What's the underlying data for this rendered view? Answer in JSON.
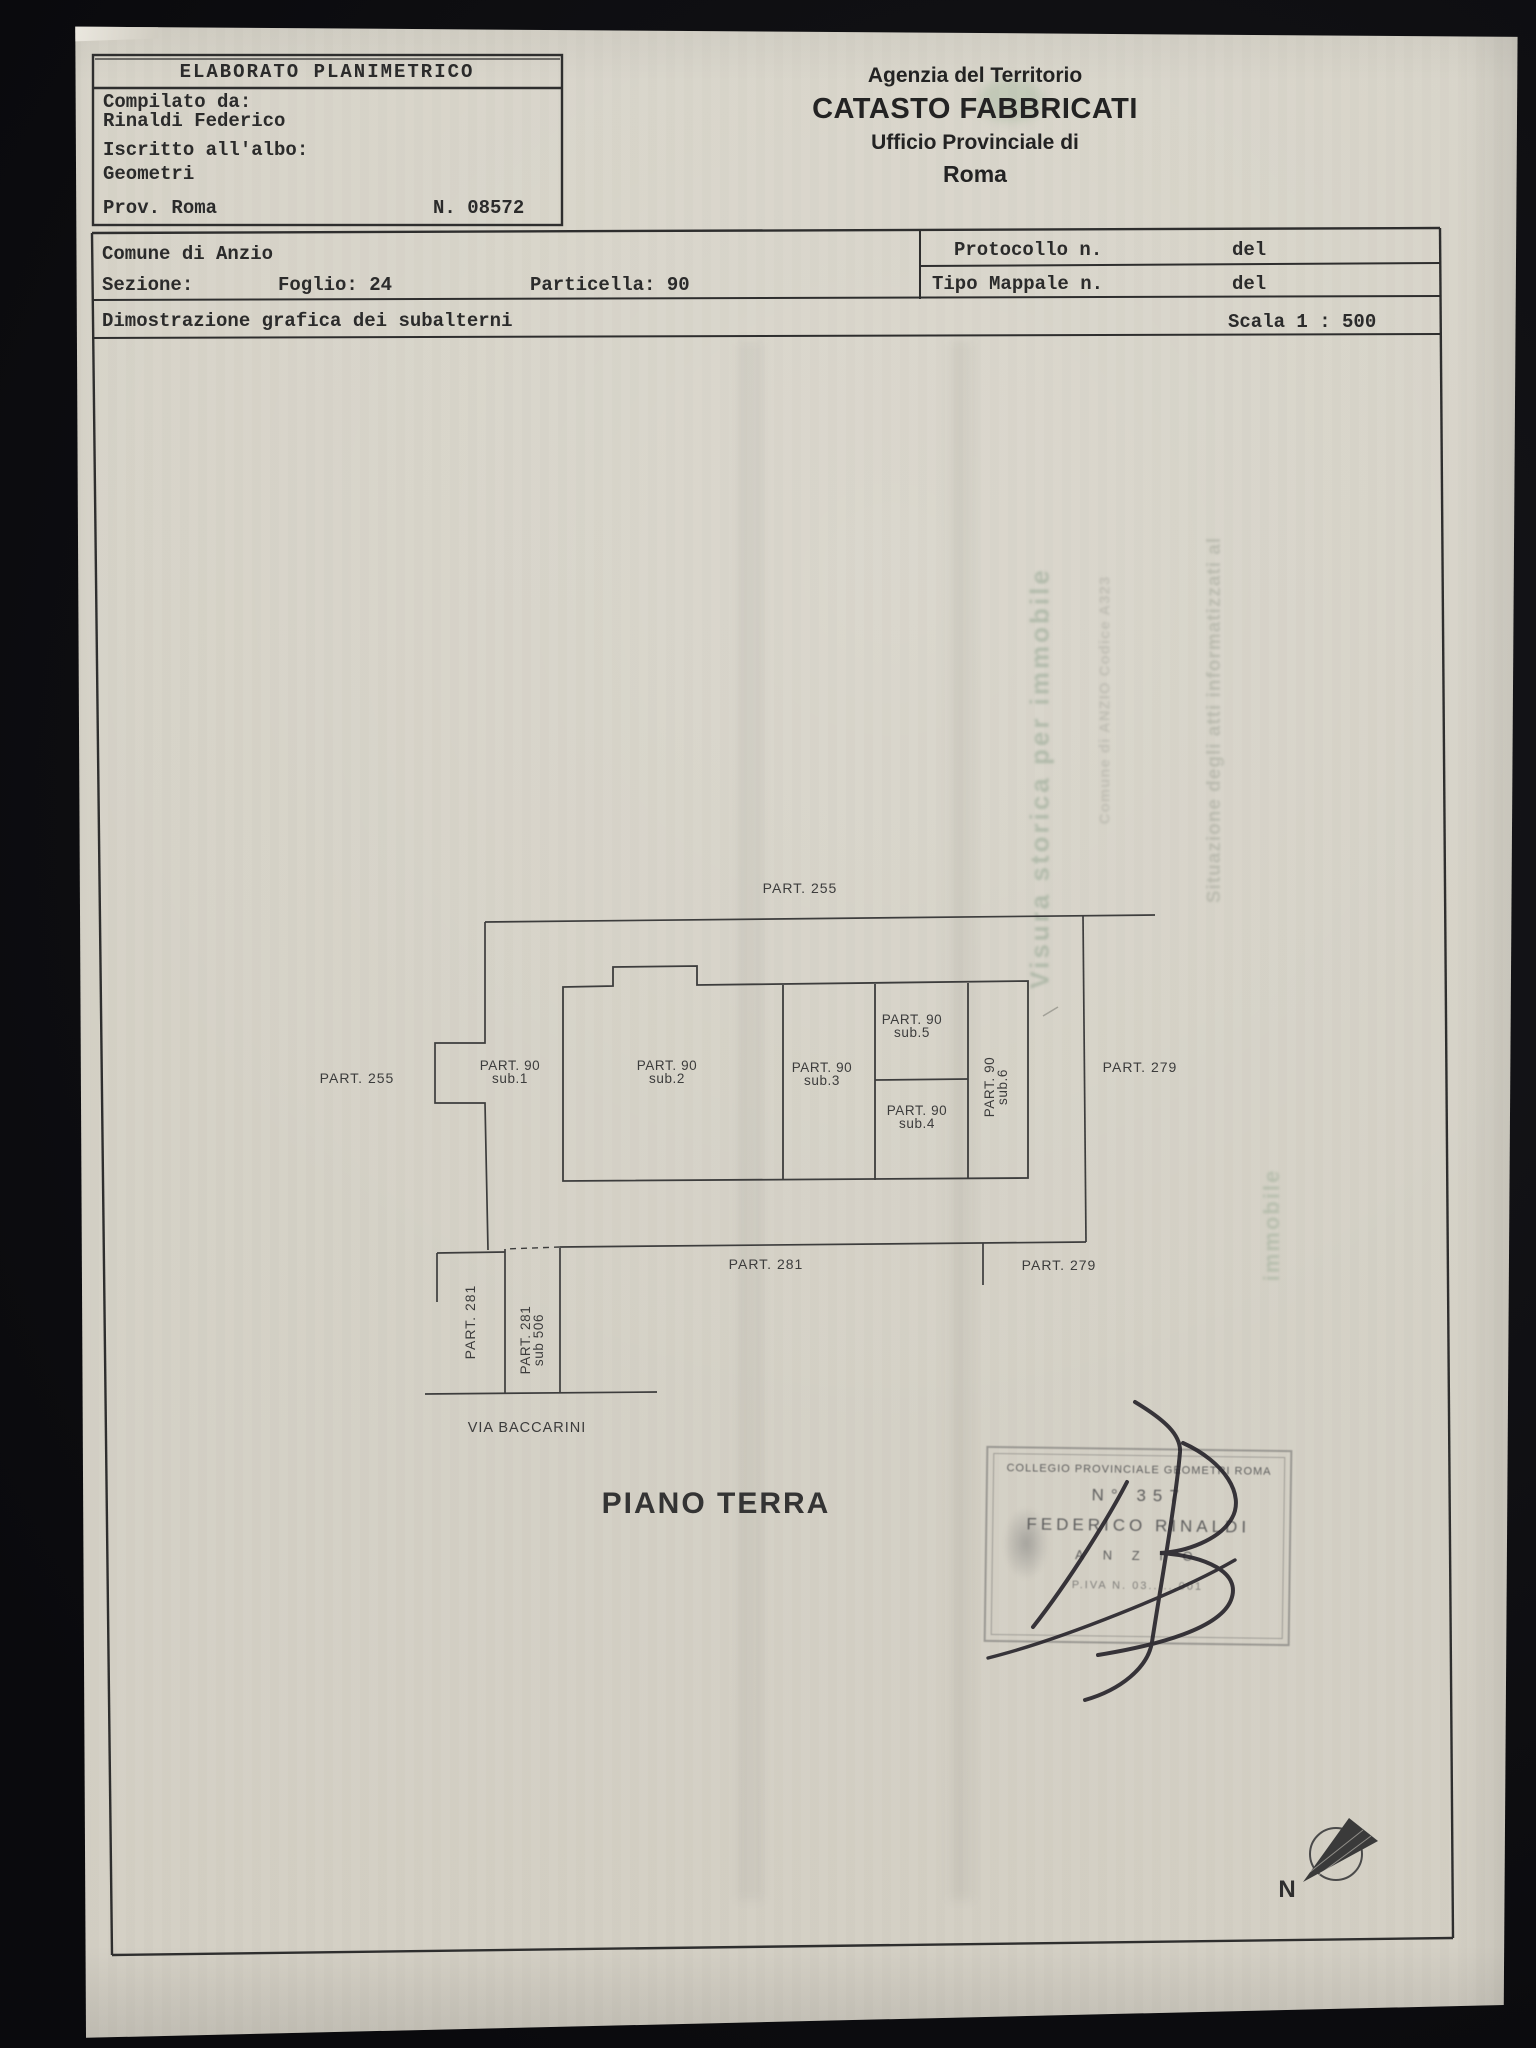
{
  "elaborato_box": {
    "title": "ELABORATO PLANIMETRICO",
    "compilato_label": "Compilato da:",
    "compilato_value": "Rinaldi Federico",
    "albo_label": "Iscritto all'albo:",
    "albo_value": "Geometri",
    "prov": "Prov. Roma",
    "numero": "N. 08572"
  },
  "agenzia": {
    "line1": "Agenzia del Territorio",
    "line2": "CATASTO FABBRICATI",
    "line3": "Ufficio Provinciale di",
    "line4": "Roma"
  },
  "info": {
    "comune": "Comune di Anzio",
    "sezione": "Sezione:",
    "foglio": "Foglio: 24",
    "particella": "Particella: 90",
    "protocollo": "Protocollo n.",
    "protocollo_del": "del",
    "tipo_mappale": "Tipo Mappale n.",
    "tipo_mappale_del": "del",
    "subtitle": "Dimostrazione grafica dei subalterni",
    "scala": "Scala 1 : 500"
  },
  "plan": {
    "part_255_top": "PART. 255",
    "part_255_left": "PART. 255",
    "part_279_right": "PART. 279",
    "part_281_bottom": "PART. 281",
    "part_279_bottom": "PART. 279",
    "sub1": {
      "l1": "PART. 90",
      "l2": "sub.1"
    },
    "sub2": {
      "l1": "PART. 90",
      "l2": "sub.2"
    },
    "sub3": {
      "l1": "PART. 90",
      "l2": "sub.3"
    },
    "sub4": {
      "l1": "PART. 90",
      "l2": "sub.4"
    },
    "sub5": {
      "l1": "PART. 90",
      "l2": "sub.5"
    },
    "sub6": {
      "l1": "PART. 90",
      "l2": "sub.6"
    },
    "strip_281": "PART. 281",
    "strip_506": {
      "l1": "PART. 281",
      "l2": "sub 506"
    },
    "street": "VIA BACCARINI",
    "floor_title": "PIANO TERRA"
  },
  "stamp": {
    "line1": "COLLEGIO PROVINCIALE GEOMETRI ROMA",
    "line2": "N° 357",
    "line3": "FEDERICO RINALDI",
    "line4": "A N Z I O",
    "line5": "P.IVA N. 03......001"
  },
  "compass": {
    "label": "N"
  },
  "bleedthrough": {
    "col1": "Visura storica per immobile",
    "col2": "Situazione degli atti informatizzati al",
    "col3": "Comune di ANZIO Codice A323",
    "col4": "immobile"
  }
}
